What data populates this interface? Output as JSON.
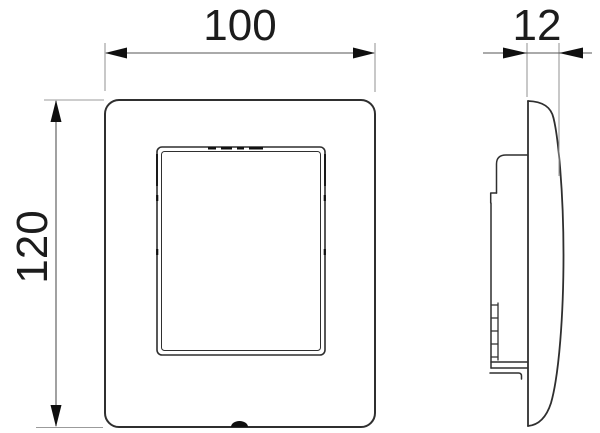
{
  "dimensions": {
    "width_label": "100",
    "height_label": "120",
    "thickness_label": "12"
  },
  "colors": {
    "background": "#ffffff",
    "object_line": "#2f2f2f",
    "dimension_line": "#555555",
    "extension_line": "#9b9b9b",
    "arrow": "#0f0f0f",
    "text": "#1c1c1c"
  }
}
